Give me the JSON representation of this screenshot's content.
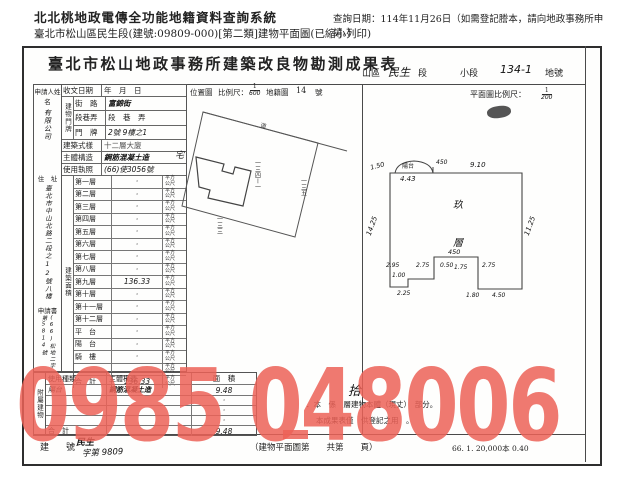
{
  "header": {
    "system_title": "北北桃地政電傳全功能地籍資料查詢系統",
    "query_date": "查詢日期：114年11月26日（如需登記謄本，請向地政事務所申請。）",
    "doc_line": "臺北市松山區民生段(建號:09809-000)[第二類]建物平面圖(已縮小列印)"
  },
  "form": {
    "title": "臺北市松山地政事務所建築改良物勘測成果表",
    "loc": {
      "district": "山區",
      "section": "民生",
      "section_label": "段",
      "small_section_label": "小段",
      "lot": "134-1",
      "lot_label": "地號"
    },
    "scales": {
      "recv_label": "收文日期",
      "ymd": "年　月　日",
      "pos_label": "位置圖",
      "ratio_label": "比例尺：",
      "pos_num": "1",
      "pos_den": "600",
      "cad_label": "地籍圖",
      "cad_no": "14",
      "cad_suffix": "號",
      "plan_label": "平面圖比例尺：",
      "plan_num": "1",
      "plan_den": "200"
    },
    "applicant": {
      "label": "申請人姓名",
      "name": "有限公司",
      "addr_label": "住　址",
      "addr": "臺北市中山北路二段之12號八樓",
      "app_label": "申請書",
      "app_no": "(66)松地二字第5814號"
    },
    "fields": {
      "doorplate_label": "建物門牌",
      "street_label": "街　路",
      "street": "富錦街",
      "lane_label": "段巷弄",
      "lane": "段　巷　弄",
      "door_label": "門　牌",
      "door": "2號 9樓之1",
      "style_label": "建築式樣",
      "style": "十二層大廈",
      "structure_label": "主體構造",
      "structure": "鋼筋混凝土造",
      "license_label": "使用執照",
      "license": "(66)使3056號"
    },
    "floors": {
      "group": "建築面積",
      "unit": "平方公尺",
      "rows": [
        {
          "label": "第一層",
          "value": "·"
        },
        {
          "label": "第二層",
          "value": "·"
        },
        {
          "label": "第三層",
          "value": "·"
        },
        {
          "label": "第四層",
          "value": "·"
        },
        {
          "label": "第五層",
          "value": "·"
        },
        {
          "label": "第六層",
          "value": "·"
        },
        {
          "label": "第七層",
          "value": "·"
        },
        {
          "label": "第八層",
          "value": "·"
        },
        {
          "label": "第九層",
          "value": "136.33"
        },
        {
          "label": "第十層",
          "value": "·"
        },
        {
          "label": "第十一層",
          "value": "·"
        },
        {
          "label": "第十二層",
          "value": "·"
        },
        {
          "label": "平　台",
          "value": "·"
        },
        {
          "label": "陽　台",
          "value": "·"
        },
        {
          "label": "騎　樓",
          "value": "·"
        },
        {
          "label": "",
          "value": "·"
        },
        {
          "label": "合　計",
          "value": "136.33"
        }
      ]
    },
    "annex": {
      "group": "附屬建物",
      "h_usage": "使用種類",
      "h_structure": "主體構造",
      "h_area": "面　積",
      "rows": [
        {
          "usage": "陽台",
          "structure": "鋼筋混凝土造",
          "area": "9.48"
        },
        {
          "usage": "",
          "structure": "",
          "area": "·"
        },
        {
          "usage": "",
          "structure": "",
          "area": "·"
        },
        {
          "usage": "",
          "structure": "",
          "area": "·"
        },
        {
          "usage": "合　計",
          "structure": "",
          "area": "9.48"
        }
      ]
    },
    "notes": {
      "hand_char": "拾",
      "line1": "．本　係　層建物本體（現丈）　部分。",
      "line2": "本成果表僅　供登記之用　。"
    },
    "footer": {
      "bno_label": "建　號",
      "bno_section": "民生",
      "bno_value": "字第 9809",
      "page_note": "（建物平面圖第　　共第　　頁）",
      "print_code": "66. 1. 20,000本 0.40"
    }
  },
  "location_map": {
    "road": "道",
    "lot_main": "一三四ー一",
    "lot_right": "一三五",
    "lot_bottom": "一三三",
    "site_mark": "宅"
  },
  "floor_plan": {
    "balcony": "陽台",
    "room_char1": "玖",
    "room_char2": "層",
    "dims": {
      "d_tl": "1.50",
      "d_balcony": "4.43",
      "d_top_mid": "450",
      "d_top": "9.10",
      "d_left": "14.25",
      "d_right": "11.25",
      "d_notch_top": "450",
      "d_n1": "2.75",
      "d_n2": "0.50",
      "d_n3": "1.75",
      "d_n4": "2.75",
      "d_l1": "2.95",
      "d_l2": "1.00",
      "d_l3": "2.25",
      "d_b1": "1.80",
      "d_b2": "4.50"
    }
  },
  "watermark": {
    "text": "0985 048006",
    "color": "#ec6257"
  }
}
